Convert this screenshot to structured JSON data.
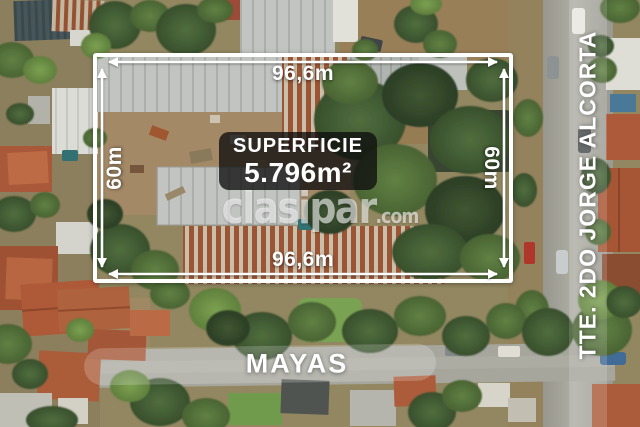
{
  "measurements": {
    "top": "96,6m",
    "bottom": "96,6m",
    "left": "60m",
    "right": "60m"
  },
  "area": {
    "label": "SUPERFICIE",
    "value": "5.796m²"
  },
  "watermark": {
    "name": "clasipar",
    "tld": ".com"
  },
  "streets": {
    "bottom": "MAYAS",
    "right": "TTE. 2DO JORGE ALCORTA"
  },
  "colors": {
    "overlay_white": "#ffffff",
    "panel_bg": "rgba(14,14,14,0.78)",
    "band_bg": "rgba(255,255,255,0.2)",
    "terracotta_roof": "#b25c38",
    "tree_green": "#4c6a38",
    "street_gray": "#a8a8a0"
  }
}
